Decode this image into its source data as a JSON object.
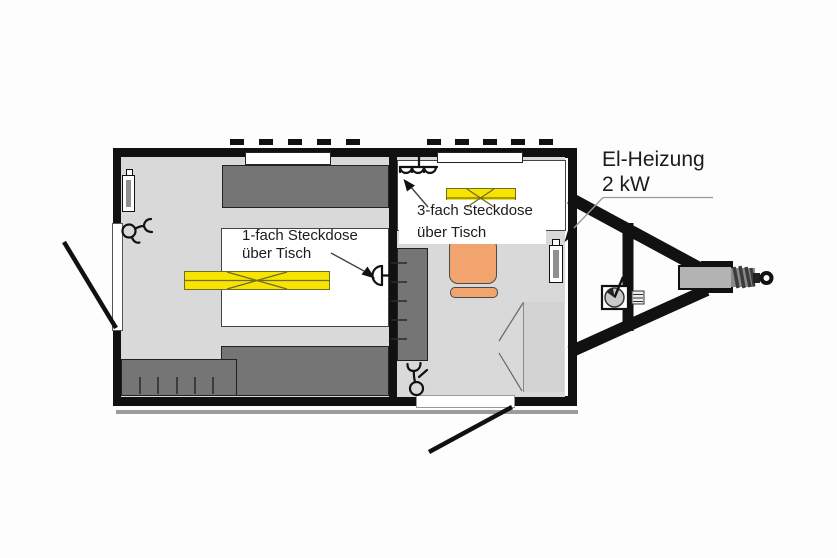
{
  "labels": {
    "heating": {
      "line1": "El-Heizung",
      "line2": "2 kW"
    },
    "single_socket": {
      "line1": "1-fach Steckdose",
      "line2": "über Tisch"
    },
    "triple_socket": {
      "line1": "3-fach Steckdose",
      "line2": "über Tisch"
    }
  },
  "colors": {
    "wall": "#111111",
    "floor": "#d9d9d9",
    "furniture": "#757575",
    "table": "#ffffff",
    "lamp": "#f9e300",
    "lamp_border": "#6e6e28",
    "chair": "#f2a46f",
    "chair_border": "#4a4a4a",
    "metal": "#b3b3b3",
    "shadow": "#9c9c9c",
    "leader": "#999999",
    "text": "#1c1c1e"
  }
}
